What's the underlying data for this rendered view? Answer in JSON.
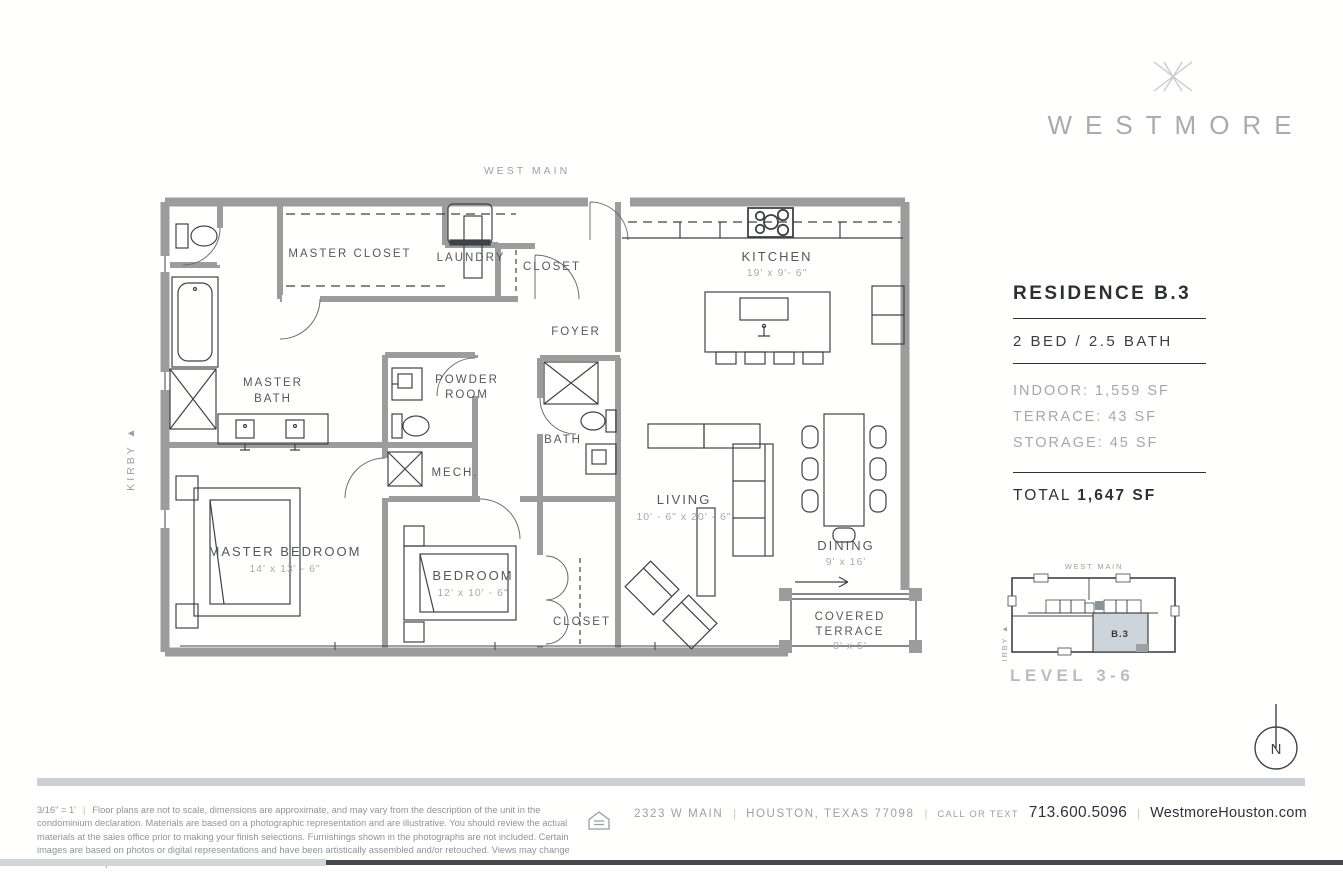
{
  "brand": {
    "name": "WESTMORE"
  },
  "plan": {
    "street_top": "WEST MAIN",
    "street_left": "KIRBY ▲",
    "rooms": {
      "master_closet": "MASTER CLOSET",
      "laundry": "LAUNDRY",
      "closet_top": "CLOSET",
      "foyer": "FOYER",
      "kitchen": "KITCHEN",
      "kitchen_dims": "19' x 9'- 6\"",
      "master_bath_l1": "MASTER",
      "master_bath_l2": "BATH",
      "powder_l1": "POWDER",
      "powder_l2": "ROOM",
      "bath": "BATH",
      "mech": "MECH.",
      "living": "LIVING",
      "living_dims": "10' - 6\" x 20' - 6\"",
      "dining": "DINING",
      "dining_dims": "9' x 16'",
      "master_bedroom": "MASTER BEDROOM",
      "master_bedroom_dims": "14' x 13' - 6\"",
      "bedroom": "BEDROOM",
      "bedroom_dims": "12' x 10' - 6\"",
      "closet_bottom": "CLOSET",
      "terrace_l1": "COVERED",
      "terrace_l2": "TERRACE",
      "terrace_dims": "8' x 5'"
    }
  },
  "info": {
    "residence": "RESIDENCE B.3",
    "bed_bath": "2 BED / 2.5 BATH",
    "indoor": "INDOOR: 1,559 SF",
    "terrace": "TERRACE: 43 SF",
    "storage": "STORAGE: 45 SF",
    "total_label": "TOTAL",
    "total_value": "1,647 SF"
  },
  "key_plan": {
    "street_top": "WEST MAIN",
    "street_left": "KIRBY ▲",
    "unit": "B.3",
    "level": "LEVEL 3-6"
  },
  "compass": {
    "north": "N"
  },
  "footer": {
    "scale": "3/16\" = 1'",
    "divider": "|",
    "disclaimer": "Floor plans are not to scale, dimensions are approximate, and may vary from the description of the unit in the condominium declaration. Materials are based on a photographic representation and are illustrative. You should review the actual materials at the sales office prior to making your finish selections. Furnishings shown in the photographs are not included. Certain images are based on photos or digital representations and have been artistically assembled and/or retouched. Views may change based on development or other factors.",
    "address": "2323 W MAIN",
    "city": "HOUSTON, TEXAS 77098",
    "call_label": "CALL OR TEXT",
    "phone": "713.600.5096",
    "website": "WestmoreHouston.com"
  },
  "colors": {
    "accent_dark": "#2e3338",
    "text_gray": "#9aa0a4",
    "wall_gray": "#9c9c9c",
    "keyplan_highlight": "#cdd5da",
    "bar_light": "#d3d6d9",
    "bar_dark": "#45494d"
  }
}
